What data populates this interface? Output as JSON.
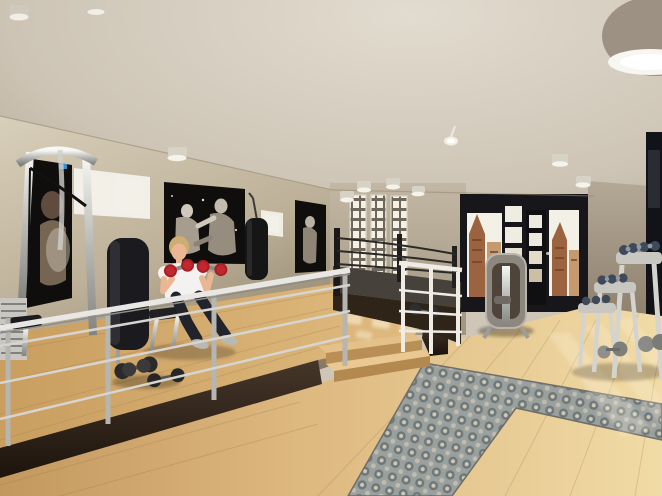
{
  "meta": {
    "title": "Loft boxing gym — photorealistic 3D interior rendering",
    "image_type": "architectural visualization, no UI text visible",
    "dimensions": "662x496"
  },
  "palette": {
    "ceiling": "#d5cdc0",
    "wall_left": "#bfb29b",
    "wall_back": "#b5a995",
    "wall_dark": "#17171b",
    "pillar": "#a89b87",
    "floor_light": "#eed7a2",
    "floor_mid": "#cfa76b",
    "platform_wood": "#d3a967",
    "fascia_dark": "#31251a",
    "rug_base": "#9aa09e",
    "chrome": "#d9d8d4",
    "white_rail": "#efece6",
    "poster_bg": "#0f0e0d",
    "bag_black": "#161616",
    "ring_base": "#2f2418",
    "ring_apron": "#46413a",
    "skin": "#eab694",
    "hair_blonde": "#cead72",
    "shirt_white": "#f4f2f0",
    "pants_dark": "#23232c",
    "shoes_grey": "#b9b9b4",
    "dumbbell_red": "#c1272d",
    "sky": "#f3f0e7",
    "brick": "#9c6340",
    "brick_light": "#c49a6e"
  },
  "scene": {
    "room": {
      "type": "double-height loft gym with mezzanine platform",
      "left_wall": "beige travertine plaster with two white-framed windows and framed black-and-white boxing photographs",
      "back_wall": "beige wall with three tall leaded-glass block windows behind boxing ring",
      "right_wall": "black steel-framed glazed wall and door with view of historic brick gabled buildings",
      "floor": "light oak plank flooring with L-shaped ornamental grey tile rug inset",
      "ceiling": "beige curved ceiling with round surface-mounted downlights"
    },
    "objects": [
      {
        "id": "cable-machine",
        "label": "chrome cable / lat pulldown machine with weight stack, far left"
      },
      {
        "id": "poster-boxer-left",
        "label": "dark boxing photograph behind cable machine"
      },
      {
        "id": "window-left-a",
        "label": "two-pane white window, left wall"
      },
      {
        "id": "upright-pad-machine",
        "label": "black upright padded machine back"
      },
      {
        "id": "woman-exerciser",
        "label": "blonde woman in white t-shirt and dark pants seated on bench curling two red dumbbells"
      },
      {
        "id": "poster-boxing-match",
        "label": "large black-and-white photo of two boxers fighting"
      },
      {
        "id": "punching-bag",
        "label": "black heavy punching bag hanging on chain"
      },
      {
        "id": "window-left-b",
        "label": "small white window, left wall"
      },
      {
        "id": "poster-boxer-right",
        "label": "vertical black-and-white boxer photograph"
      },
      {
        "id": "pattern-windows",
        "label": "three tall glass-block windows, centre back wall"
      },
      {
        "id": "boxing-ring",
        "label": "dark boxing ring with three ropes on raised timber base"
      },
      {
        "id": "steps",
        "label": "two oak steps from main floor up to mezzanine platform"
      },
      {
        "id": "railing-chrome",
        "label": "chromed steel guard railing along mezzanine edge"
      },
      {
        "id": "railing-white",
        "label": "white painted railing beside the steps"
      },
      {
        "id": "glazed-door",
        "label": "black steel door with small panes and lever handle"
      },
      {
        "id": "city-view",
        "label": "historic brick buildings with stepped gables seen through glazing"
      },
      {
        "id": "weight-machine",
        "label": "selectorized weight machine in front of glazed wall"
      },
      {
        "id": "dumbbell-racks",
        "label": "three staggered dumbbell stands with dumbbells, right side"
      },
      {
        "id": "floor-dumbbells",
        "label": "loose dumbbells lying on platform and main floor"
      },
      {
        "id": "rug",
        "label": "L-shaped patterned grey tile carpet inset in oak floor"
      },
      {
        "id": "ceiling-lights",
        "label": "nine round downlights plus large drum light in top-right corner"
      },
      {
        "id": "light-patches",
        "label": "daylight reflections on floor from windows"
      }
    ]
  }
}
